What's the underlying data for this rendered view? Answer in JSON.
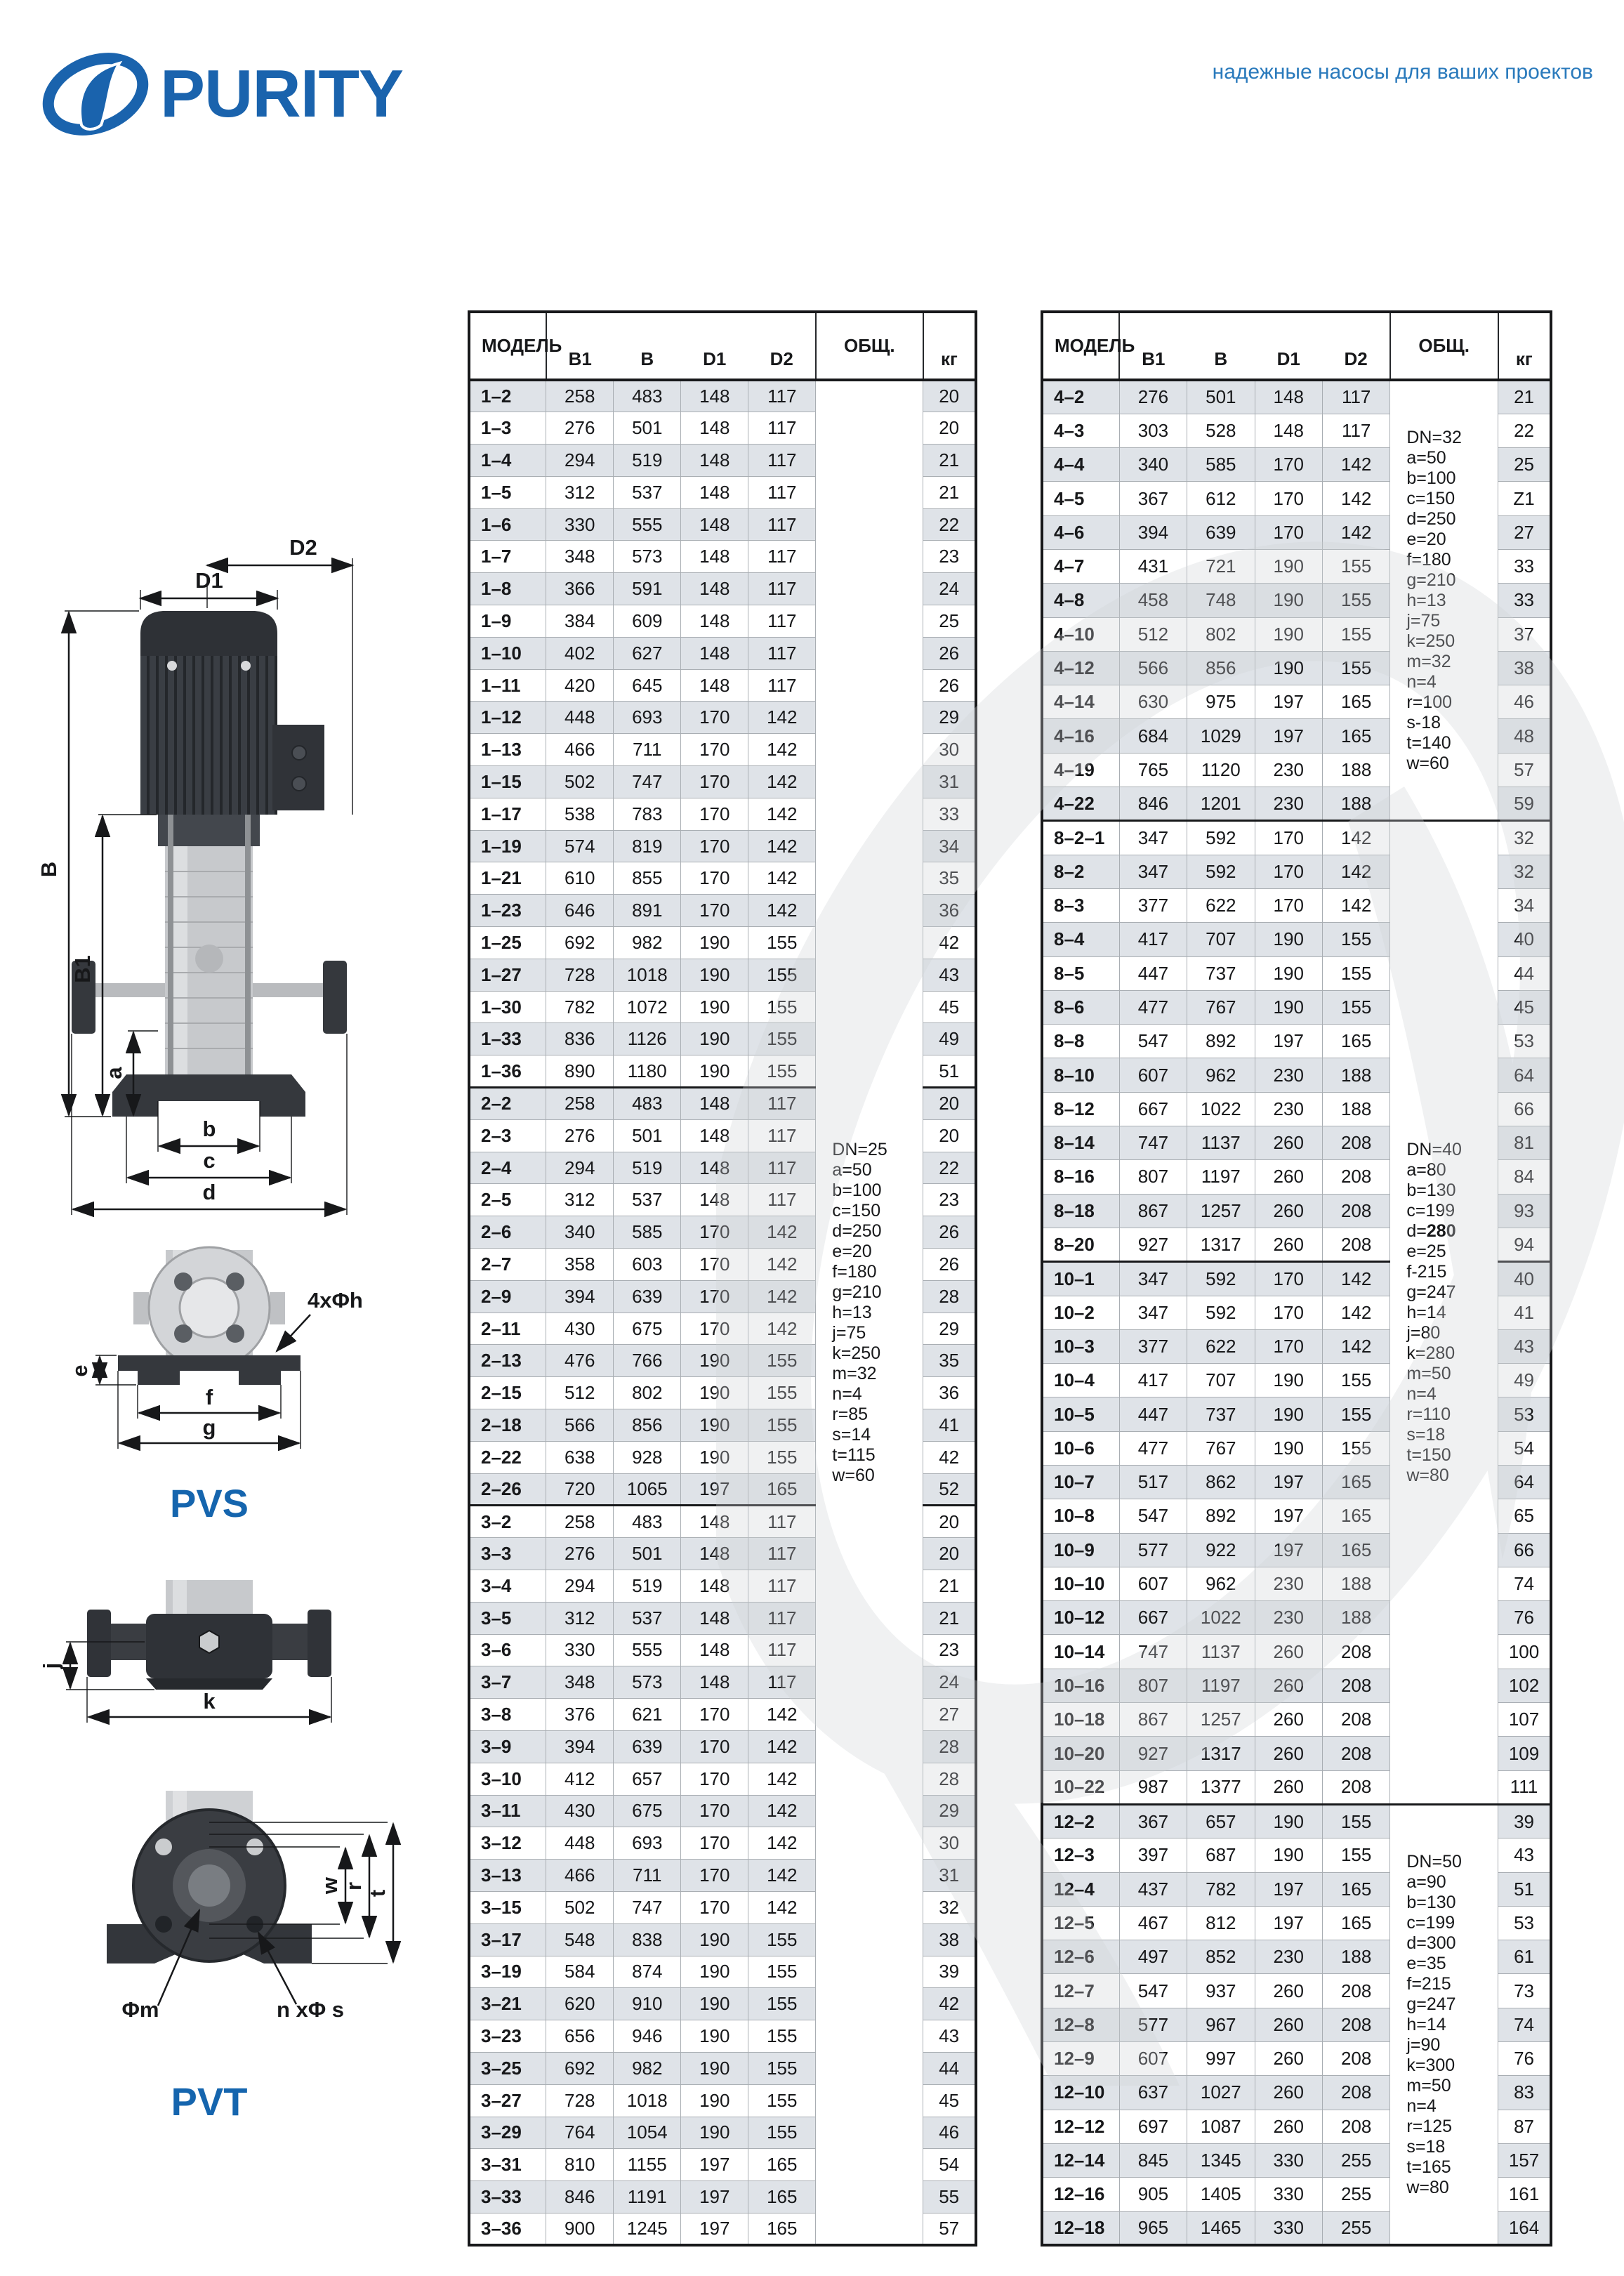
{
  "brand": {
    "logo_text": "PURITY",
    "tagline": "надежные насосы для ваших проектов"
  },
  "diagram": {
    "d2": "D2",
    "d1": "D1",
    "b_outer": "B",
    "b1": "B1",
    "a": "a",
    "b": "b",
    "c": "c",
    "d": "d",
    "holes": "4xΦh",
    "e": "e",
    "f": "f",
    "g": "g",
    "pvs": "PVS",
    "j": "j",
    "k": "k",
    "phi_m": "Φm",
    "n_phi_s": "n xΦ s",
    "w": "w",
    "r": "r",
    "t": "t",
    "pvt": "PVT"
  },
  "table_columns": {
    "model": "МОДЕЛЬ",
    "b1": "B1",
    "b": "B",
    "d1": "D1",
    "d2": "D2",
    "total": "ОБЩ.",
    "kg": "кг"
  },
  "tables": [
    {
      "name": "left",
      "groups": [
        {
          "rows": [
            [
              "1–2",
              258,
              483,
              148,
              117,
              20
            ],
            [
              "1–3",
              276,
              501,
              148,
              117,
              20
            ],
            [
              "1–4",
              294,
              519,
              148,
              117,
              21
            ],
            [
              "1–5",
              312,
              537,
              148,
              117,
              21
            ],
            [
              "1–6",
              330,
              555,
              148,
              117,
              22
            ],
            [
              "1–7",
              348,
              573,
              148,
              117,
              23
            ],
            [
              "1–8",
              366,
              591,
              148,
              117,
              24
            ],
            [
              "1–9",
              384,
              609,
              148,
              117,
              25
            ],
            [
              "1–10",
              402,
              627,
              148,
              117,
              26
            ],
            [
              "1–11",
              420,
              645,
              148,
              117,
              26
            ],
            [
              "1–12",
              448,
              693,
              170,
              142,
              29
            ],
            [
              "1–13",
              466,
              711,
              170,
              142,
              30
            ],
            [
              "1–15",
              502,
              747,
              170,
              142,
              31
            ],
            [
              "1–17",
              538,
              783,
              170,
              142,
              33
            ],
            [
              "1–19",
              574,
              819,
              170,
              142,
              34
            ],
            [
              "1–21",
              610,
              855,
              170,
              142,
              35
            ],
            [
              "1–23",
              646,
              891,
              170,
              142,
              36
            ],
            [
              "1–25",
              692,
              982,
              190,
              155,
              42
            ],
            [
              "1–27",
              728,
              1018,
              190,
              155,
              43
            ],
            [
              "1–30",
              782,
              1072,
              190,
              155,
              45
            ],
            [
              "1–33",
              836,
              1126,
              190,
              155,
              49
            ],
            [
              "1–36",
              890,
              1180,
              190,
              155,
              51
            ]
          ]
        },
        {
          "rows": [
            [
              "2–2",
              258,
              483,
              148,
              117,
              20
            ],
            [
              "2–3",
              276,
              501,
              148,
              117,
              20
            ],
            [
              "2–4",
              294,
              519,
              148,
              117,
              22
            ],
            [
              "2–5",
              312,
              537,
              148,
              117,
              23
            ],
            [
              "2–6",
              340,
              585,
              170,
              142,
              26
            ],
            [
              "2–7",
              358,
              603,
              170,
              142,
              26
            ],
            [
              "2–9",
              394,
              639,
              170,
              142,
              28
            ],
            [
              "2–11",
              430,
              675,
              170,
              142,
              29
            ],
            [
              "2–13",
              476,
              766,
              190,
              155,
              35
            ],
            [
              "2–15",
              512,
              802,
              190,
              155,
              36
            ],
            [
              "2–18",
              566,
              856,
              190,
              155,
              41
            ],
            [
              "2–22",
              638,
              928,
              190,
              155,
              42
            ],
            [
              "2–26",
              720,
              1065,
              197,
              165,
              52
            ]
          ]
        },
        {
          "rows": [
            [
              "3–2",
              258,
              483,
              148,
              117,
              20
            ],
            [
              "3–3",
              276,
              501,
              148,
              117,
              20
            ],
            [
              "3–4",
              294,
              519,
              148,
              117,
              21
            ],
            [
              "3–5",
              312,
              537,
              148,
              117,
              21
            ],
            [
              "3–6",
              330,
              555,
              148,
              117,
              23
            ],
            [
              "3–7",
              348,
              573,
              148,
              117,
              24
            ],
            [
              "3–8",
              376,
              621,
              170,
              142,
              27
            ],
            [
              "3–9",
              394,
              639,
              170,
              142,
              28
            ],
            [
              "3–10",
              412,
              657,
              170,
              142,
              28
            ],
            [
              "3–11",
              430,
              675,
              170,
              142,
              29
            ],
            [
              "3–12",
              448,
              693,
              170,
              142,
              30
            ],
            [
              "3–13",
              466,
              711,
              170,
              142,
              31
            ],
            [
              "3–15",
              502,
              747,
              170,
              142,
              32
            ],
            [
              "3–17",
              548,
              838,
              190,
              155,
              38
            ],
            [
              "3–19",
              584,
              874,
              190,
              155,
              39
            ],
            [
              "3–21",
              620,
              910,
              190,
              155,
              42
            ],
            [
              "3–23",
              656,
              946,
              190,
              155,
              43
            ],
            [
              "3–25",
              692,
              982,
              190,
              155,
              44
            ],
            [
              "3–27",
              728,
              1018,
              190,
              155,
              45
            ],
            [
              "3–29",
              764,
              1054,
              190,
              155,
              46
            ],
            [
              "3–31",
              810,
              1155,
              197,
              165,
              54
            ],
            [
              "3–33",
              846,
              1191,
              197,
              165,
              55
            ],
            [
              "3–36",
              900,
              1245,
              197,
              165,
              57
            ]
          ]
        }
      ],
      "info_spans": [
        {
          "groups": [
            0,
            1,
            2
          ],
          "lines": [
            "DN=25",
            "a=50",
            "b=100",
            "c=150",
            "d=250",
            "e=20",
            "f=180",
            "g=210",
            "h=13",
            "j=75",
            "k=250",
            "m=32",
            "n=4",
            "r=85",
            "s=14",
            "t=115",
            "w=60"
          ]
        }
      ]
    },
    {
      "name": "right",
      "groups": [
        {
          "rows": [
            [
              "4–2",
              276,
              501,
              148,
              117,
              21
            ],
            [
              "4–3",
              303,
              528,
              148,
              117,
              22
            ],
            [
              "4–4",
              340,
              585,
              170,
              142,
              25
            ],
            [
              "4–5",
              367,
              612,
              170,
              142,
              "Z1"
            ],
            [
              "4–6",
              394,
              639,
              170,
              142,
              27
            ],
            [
              "4–7",
              431,
              721,
              190,
              155,
              33
            ],
            [
              "4–8",
              458,
              748,
              190,
              155,
              33
            ],
            [
              "4–10",
              512,
              802,
              190,
              155,
              37
            ],
            [
              "4–12",
              566,
              856,
              190,
              155,
              38
            ],
            [
              "4–14",
              630,
              975,
              197,
              165,
              46
            ],
            [
              "4–16",
              684,
              1029,
              197,
              165,
              48
            ],
            [
              "4–19",
              765,
              1120,
              230,
              188,
              57
            ],
            [
              "4–22",
              846,
              1201,
              230,
              188,
              59
            ]
          ]
        },
        {
          "rows": [
            [
              "8–2–1",
              347,
              592,
              170,
              142,
              32
            ],
            [
              "8–2",
              347,
              592,
              170,
              142,
              32
            ],
            [
              "8–3",
              377,
              622,
              170,
              142,
              34
            ],
            [
              "8–4",
              417,
              707,
              190,
              155,
              40
            ],
            [
              "8–5",
              447,
              737,
              190,
              155,
              44
            ],
            [
              "8–6",
              477,
              767,
              190,
              155,
              45
            ],
            [
              "8–8",
              547,
              892,
              197,
              165,
              53
            ],
            [
              "8–10",
              607,
              962,
              230,
              188,
              64
            ],
            [
              "8–12",
              667,
              1022,
              230,
              188,
              66
            ],
            [
              "8–14",
              747,
              1137,
              260,
              208,
              81
            ],
            [
              "8–16",
              807,
              1197,
              260,
              208,
              84
            ],
            [
              "8–18",
              867,
              1257,
              260,
              208,
              93
            ],
            [
              "8–20",
              927,
              1317,
              260,
              208,
              94
            ]
          ]
        },
        {
          "rows": [
            [
              "10–1",
              347,
              592,
              170,
              142,
              40
            ],
            [
              "10–2",
              347,
              592,
              170,
              142,
              41
            ],
            [
              "10–3",
              377,
              622,
              170,
              142,
              43
            ],
            [
              "10–4",
              417,
              707,
              190,
              155,
              49
            ],
            [
              "10–5",
              447,
              737,
              190,
              155,
              53
            ],
            [
              "10–6",
              477,
              767,
              190,
              155,
              54
            ],
            [
              "10–7",
              517,
              862,
              197,
              165,
              64
            ],
            [
              "10–8",
              547,
              892,
              197,
              165,
              65
            ],
            [
              "10–9",
              577,
              922,
              197,
              165,
              66
            ],
            [
              "10–10",
              607,
              962,
              230,
              188,
              74
            ],
            [
              "10–12",
              667,
              1022,
              230,
              188,
              76
            ],
            [
              "10–14",
              747,
              1137,
              260,
              208,
              100
            ],
            [
              "10–16",
              807,
              1197,
              260,
              208,
              102
            ],
            [
              "10–18",
              867,
              1257,
              260,
              208,
              107
            ],
            [
              "10–20",
              927,
              1317,
              260,
              208,
              109
            ],
            [
              "10–22",
              987,
              1377,
              260,
              208,
              111
            ]
          ]
        },
        {
          "rows": [
            [
              "12–2",
              367,
              657,
              190,
              155,
              39
            ],
            [
              "12–3",
              397,
              687,
              190,
              155,
              43
            ],
            [
              "12–4",
              437,
              782,
              197,
              165,
              51
            ],
            [
              "12–5",
              467,
              812,
              197,
              165,
              53
            ],
            [
              "12–6",
              497,
              852,
              230,
              188,
              61
            ],
            [
              "12–7",
              547,
              937,
              260,
              208,
              73
            ],
            [
              "12–8",
              577,
              967,
              260,
              208,
              74
            ],
            [
              "12–9",
              607,
              997,
              260,
              208,
              76
            ],
            [
              "12–10",
              637,
              1027,
              260,
              208,
              83
            ],
            [
              "12–12",
              697,
              1087,
              260,
              208,
              87
            ],
            [
              "12–14",
              845,
              1345,
              330,
              255,
              157
            ],
            [
              "12–16",
              905,
              1405,
              330,
              255,
              161
            ],
            [
              "12–18",
              965,
              1465,
              330,
              255,
              164
            ]
          ]
        }
      ],
      "info_spans": [
        {
          "groups": [
            0
          ],
          "lines": [
            "DN=32",
            "a=50",
            "b=100",
            "c=150",
            "d=250",
            "e=20",
            "f=180",
            "g=210",
            "h=13",
            "j=75",
            "k=250",
            "m=32",
            "n=4",
            "r=100",
            "s-18",
            "t=140",
            "w=60"
          ]
        },
        {
          "groups": [
            1,
            2
          ],
          "lines": [
            "DN=40",
            "a=80",
            "b=130",
            "c=199",
            "d=**280**",
            "e=25",
            "f-215",
            "g=247",
            "h=14",
            "j=80",
            "k=280",
            "m=50",
            "n=4",
            "r=110",
            "s=18",
            "t=150",
            "w=80"
          ]
        },
        {
          "groups": [
            3
          ],
          "lines": [
            "DN=50",
            "a=90",
            "b=130",
            "c=199",
            "d=300",
            "e=35",
            "f=215",
            "g=247",
            "h=14",
            "j=90",
            "k=300",
            "m=50",
            "n=4",
            "r=125",
            "s=18",
            "t=165",
            "w=80"
          ]
        }
      ]
    }
  ]
}
